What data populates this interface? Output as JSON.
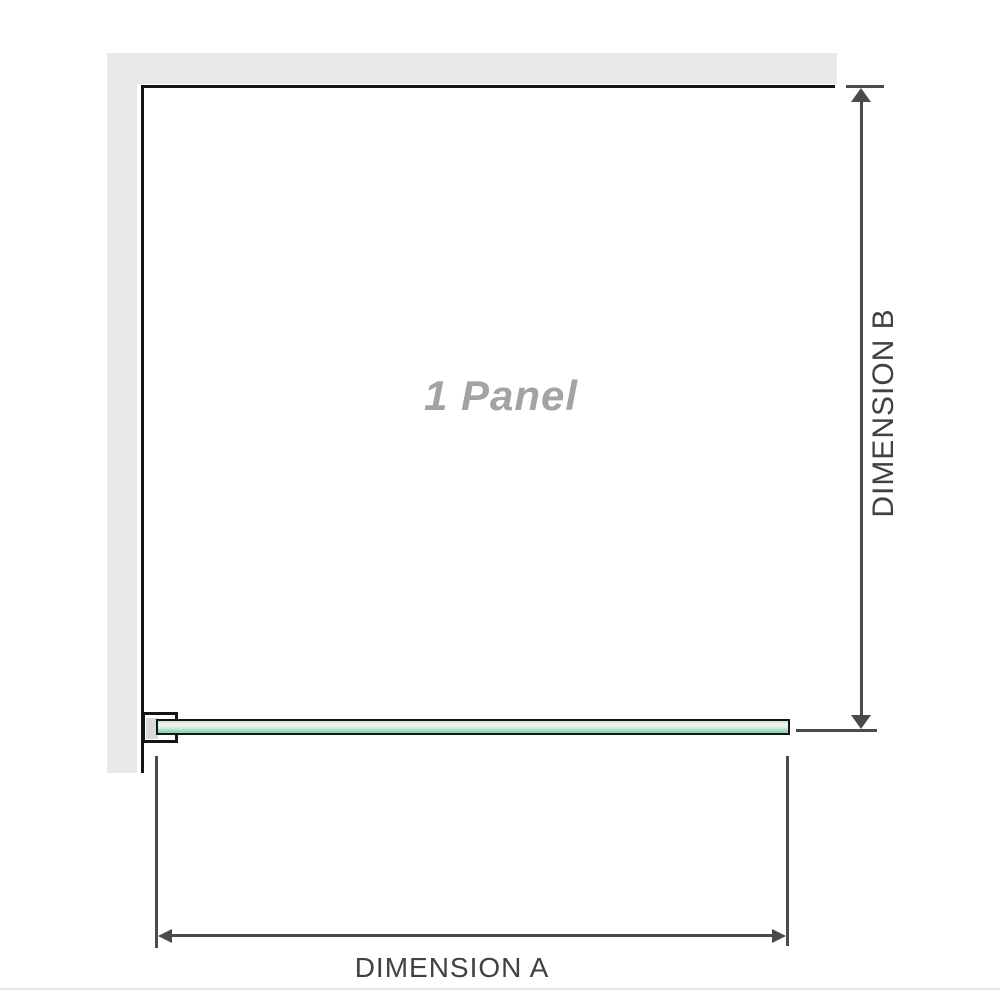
{
  "diagram": {
    "panel_label": "1 Panel",
    "dimension_a_label": "DIMENSION A",
    "dimension_b_label": "DIMENSION B"
  },
  "colors": {
    "wall": "#e9e9e9",
    "outline": "#151515",
    "dimension_line": "#4a4a4a",
    "label_text": "#414141",
    "panel_text": "#a3a3a3",
    "glass_green": "#9cd6b5",
    "glass_highlight": "#eef9f3",
    "bracket_inner": "#d9d9d9",
    "divider": "#e7e4e0"
  }
}
